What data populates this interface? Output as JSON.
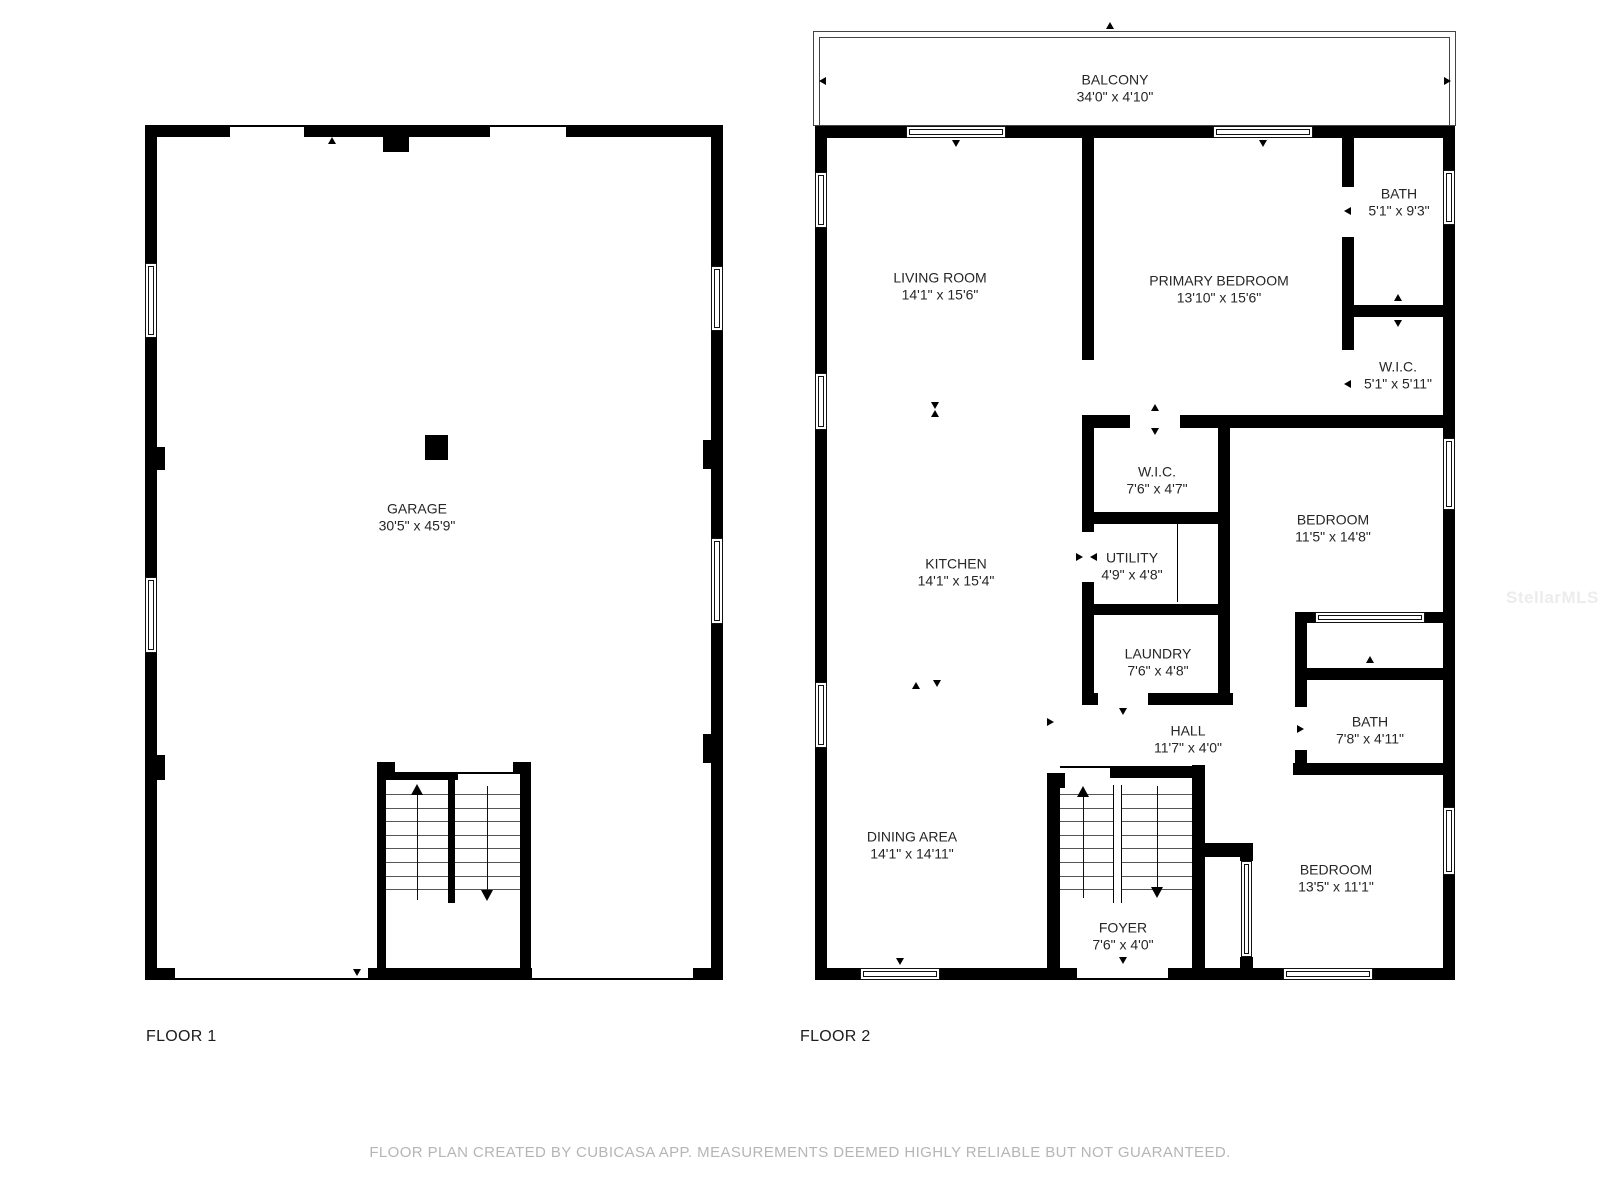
{
  "page": {
    "background": "#ffffff",
    "wall_color": "#000000",
    "label_color": "#262626",
    "tread_color": "#555555",
    "disclaimer_color": "#b5b5b5",
    "watermark_color": "#ececec"
  },
  "watermark": {
    "text": "StellarMLS",
    "x": 1506,
    "y": 588
  },
  "disclaimer": {
    "text": "FLOOR PLAN CREATED BY CUBICASA APP. MEASUREMENTS DEEMED HIGHLY RELIABLE BUT NOT GUARANTEED.",
    "y": 1144
  },
  "floors": [
    {
      "id": "floor1",
      "title": "FLOOR 1",
      "title_x": 146,
      "title_y": 1028,
      "boxes": [],
      "windows": [
        [
          145,
          263,
          12,
          75
        ],
        [
          145,
          577,
          12,
          76
        ],
        [
          711,
          266,
          12,
          65
        ],
        [
          711,
          538,
          12,
          86
        ]
      ],
      "walls": [
        [
          145,
          125,
          85,
          12
        ],
        [
          304,
          125,
          186,
          12
        ],
        [
          566,
          125,
          157,
          12
        ],
        [
          383,
          137,
          26,
          15
        ],
        [
          145,
          125,
          12,
          138
        ],
        [
          145,
          338,
          12,
          239
        ],
        [
          145,
          653,
          12,
          327
        ],
        [
          711,
          125,
          12,
          141
        ],
        [
          711,
          331,
          12,
          207
        ],
        [
          711,
          624,
          12,
          356
        ],
        [
          157,
          447,
          8,
          23
        ],
        [
          157,
          755,
          8,
          25
        ],
        [
          703,
          440,
          8,
          29
        ],
        [
          703,
          734,
          8,
          29
        ],
        [
          145,
          968,
          30,
          12
        ],
        [
          368,
          968,
          164,
          12
        ],
        [
          693,
          968,
          30,
          12
        ],
        [
          377,
          762,
          18,
          11
        ],
        [
          377,
          773,
          9,
          207
        ],
        [
          386,
          772,
          72,
          8
        ],
        [
          513,
          762,
          18,
          11
        ],
        [
          520,
          773,
          11,
          207
        ],
        [
          448,
          780,
          7,
          123
        ],
        [
          425,
          435,
          23,
          25
        ]
      ],
      "lines": [
        [
          230,
          125,
          74,
          2
        ],
        [
          490,
          125,
          76,
          2
        ],
        [
          175,
          978,
          193,
          2
        ],
        [
          532,
          978,
          161,
          2
        ],
        [
          458,
          772,
          62,
          2
        ]
      ],
      "treads": [
        [
          386,
          794,
          62,
          1
        ],
        [
          386,
          808,
          62,
          1
        ],
        [
          386,
          821,
          62,
          1
        ],
        [
          386,
          835,
          62,
          1
        ],
        [
          386,
          848,
          62,
          1
        ],
        [
          386,
          862,
          62,
          1
        ],
        [
          386,
          876,
          62,
          1
        ],
        [
          386,
          889,
          62,
          1
        ],
        [
          455,
          794,
          65,
          1
        ],
        [
          455,
          808,
          65,
          1
        ],
        [
          455,
          821,
          65,
          1
        ],
        [
          455,
          835,
          65,
          1
        ],
        [
          455,
          848,
          65,
          1
        ],
        [
          455,
          862,
          65,
          1
        ],
        [
          455,
          876,
          65,
          1
        ],
        [
          455,
          889,
          65,
          1
        ]
      ],
      "labels": [
        {
          "name": "GARAGE",
          "dims": "30'5\" x 45'9\"",
          "x": 417,
          "y": 517
        }
      ],
      "arrows": [
        {
          "x": 417,
          "y1": 784,
          "y2": 900,
          "dir": "up"
        },
        {
          "x": 487,
          "y1": 786,
          "y2": 901,
          "dir": "down"
        }
      ],
      "markers": [
        {
          "x": 332,
          "y": 141,
          "dir": "up"
        },
        {
          "x": 357,
          "y": 973,
          "dir": "down"
        }
      ]
    },
    {
      "id": "floor2",
      "title": "FLOOR 2",
      "title_x": 800,
      "title_y": 1028,
      "boxes": [
        [
          813,
          31,
          643,
          95
        ],
        [
          819,
          37,
          631,
          89
        ]
      ],
      "windows": [
        [
          815,
          172,
          12,
          56
        ],
        [
          815,
          373,
          12,
          57
        ],
        [
          815,
          682,
          12,
          66
        ],
        [
          1443,
          170,
          12,
          55
        ],
        [
          1443,
          438,
          12,
          72
        ],
        [
          1443,
          807,
          12,
          68
        ],
        [
          906,
          126,
          100,
          12
        ],
        [
          1213,
          126,
          100,
          12
        ],
        [
          1315,
          612,
          110,
          11
        ],
        [
          860,
          968,
          80,
          12
        ],
        [
          1283,
          968,
          90,
          12
        ],
        [
          1241,
          861,
          11,
          96
        ]
      ],
      "walls": [
        [
          815,
          126,
          91,
          12
        ],
        [
          1006,
          126,
          207,
          12
        ],
        [
          1313,
          126,
          142,
          12
        ],
        [
          815,
          126,
          12,
          46
        ],
        [
          815,
          228,
          12,
          145
        ],
        [
          815,
          430,
          12,
          252
        ],
        [
          815,
          748,
          12,
          232
        ],
        [
          1443,
          126,
          12,
          44
        ],
        [
          1443,
          225,
          12,
          213
        ],
        [
          1443,
          510,
          12,
          297
        ],
        [
          1443,
          875,
          12,
          105
        ],
        [
          815,
          968,
          45,
          12
        ],
        [
          940,
          968,
          137,
          12
        ],
        [
          1168,
          968,
          115,
          12
        ],
        [
          1373,
          968,
          82,
          12
        ],
        [
          1082,
          137,
          12,
          223
        ],
        [
          1082,
          415,
          12,
          117
        ],
        [
          1082,
          582,
          12,
          123
        ],
        [
          1342,
          137,
          12,
          50
        ],
        [
          1342,
          237,
          12,
          113
        ],
        [
          1354,
          305,
          89,
          12
        ],
        [
          1082,
          415,
          48,
          13
        ],
        [
          1180,
          415,
          263,
          13
        ],
        [
          1218,
          428,
          12,
          277
        ],
        [
          1082,
          512,
          148,
          12
        ],
        [
          1082,
          604,
          148,
          11
        ],
        [
          1082,
          693,
          16,
          12
        ],
        [
          1148,
          693,
          85,
          12
        ],
        [
          1295,
          612,
          12,
          93
        ],
        [
          1295,
          612,
          20,
          11
        ],
        [
          1425,
          612,
          18,
          11
        ],
        [
          1295,
          668,
          148,
          12
        ],
        [
          1295,
          680,
          12,
          27
        ],
        [
          1295,
          750,
          12,
          13
        ],
        [
          1293,
          763,
          150,
          12
        ],
        [
          1192,
          765,
          13,
          13
        ],
        [
          1192,
          766,
          13,
          77
        ],
        [
          1192,
          843,
          61,
          14
        ],
        [
          1192,
          857,
          13,
          123
        ],
        [
          1240,
          843,
          13,
          18
        ],
        [
          1240,
          957,
          13,
          23
        ],
        [
          1047,
          773,
          18,
          15
        ],
        [
          1047,
          788,
          13,
          192
        ],
        [
          1110,
          766,
          82,
          12
        ]
      ],
      "lines": [
        [
          1060,
          766,
          50,
          2
        ],
        [
          1077,
          978,
          91,
          2
        ],
        [
          1177,
          517,
          1,
          85
        ],
        [
          1113,
          785,
          1,
          118
        ],
        [
          1121,
          785,
          1,
          118
        ]
      ],
      "treads": [
        [
          1060,
          794,
          53,
          1
        ],
        [
          1060,
          808,
          53,
          1
        ],
        [
          1060,
          821,
          53,
          1
        ],
        [
          1060,
          835,
          53,
          1
        ],
        [
          1060,
          848,
          53,
          1
        ],
        [
          1060,
          862,
          53,
          1
        ],
        [
          1060,
          876,
          53,
          1
        ],
        [
          1060,
          889,
          53,
          1
        ],
        [
          1122,
          794,
          70,
          1
        ],
        [
          1122,
          808,
          70,
          1
        ],
        [
          1122,
          821,
          70,
          1
        ],
        [
          1122,
          835,
          70,
          1
        ],
        [
          1122,
          848,
          70,
          1
        ],
        [
          1122,
          862,
          70,
          1
        ],
        [
          1122,
          876,
          70,
          1
        ],
        [
          1122,
          889,
          70,
          1
        ]
      ],
      "labels": [
        {
          "name": "BALCONY",
          "dims": "34'0\" x 4'10\"",
          "x": 1115,
          "y": 88
        },
        {
          "name": "LIVING ROOM",
          "dims": "14'1\" x 15'6\"",
          "x": 940,
          "y": 286
        },
        {
          "name": "PRIMARY BEDROOM",
          "dims": "13'10\" x 15'6\"",
          "x": 1219,
          "y": 289
        },
        {
          "name": "BATH",
          "dims": "5'1\" x 9'3\"",
          "x": 1399,
          "y": 202
        },
        {
          "name": "W.I.C.",
          "dims": "5'1\" x 5'11\"",
          "x": 1398,
          "y": 375
        },
        {
          "name": "W.I.C.",
          "dims": "7'6\" x 4'7\"",
          "x": 1157,
          "y": 480
        },
        {
          "name": "UTILITY",
          "dims": "4'9\" x 4'8\"",
          "x": 1132,
          "y": 566
        },
        {
          "name": "BEDROOM",
          "dims": "11'5\" x 14'8\"",
          "x": 1333,
          "y": 528
        },
        {
          "name": "KITCHEN",
          "dims": "14'1\" x 15'4\"",
          "x": 956,
          "y": 572
        },
        {
          "name": "LAUNDRY",
          "dims": "7'6\" x 4'8\"",
          "x": 1158,
          "y": 662
        },
        {
          "name": "HALL",
          "dims": "11'7\" x 4'0\"",
          "x": 1188,
          "y": 739
        },
        {
          "name": "BATH",
          "dims": "7'8\" x 4'11\"",
          "x": 1370,
          "y": 730
        },
        {
          "name": "DINING AREA",
          "dims": "14'1\" x 14'11\"",
          "x": 912,
          "y": 845
        },
        {
          "name": "FOYER",
          "dims": "7'6\" x 4'0\"",
          "x": 1123,
          "y": 936
        },
        {
          "name": "BEDROOM",
          "dims": "13'5\" x 11'1\"",
          "x": 1336,
          "y": 878
        }
      ],
      "arrows": [
        {
          "x": 1083,
          "y1": 786,
          "y2": 898,
          "dir": "up"
        },
        {
          "x": 1157,
          "y1": 786,
          "y2": 898,
          "dir": "down"
        }
      ],
      "markers": [
        {
          "x": 1110,
          "y": 26,
          "dir": "up"
        },
        {
          "x": 823,
          "y": 81,
          "dir": "left"
        },
        {
          "x": 1448,
          "y": 81,
          "dir": "right"
        },
        {
          "x": 956,
          "y": 144,
          "dir": "down"
        },
        {
          "x": 1263,
          "y": 144,
          "dir": "down"
        },
        {
          "x": 1348,
          "y": 211,
          "dir": "left"
        },
        {
          "x": 1398,
          "y": 298,
          "dir": "up"
        },
        {
          "x": 1398,
          "y": 324,
          "dir": "down"
        },
        {
          "x": 1348,
          "y": 384,
          "dir": "left"
        },
        {
          "x": 1155,
          "y": 408,
          "dir": "up"
        },
        {
          "x": 1155,
          "y": 432,
          "dir": "down"
        },
        {
          "x": 935,
          "y": 406,
          "dir": "down"
        },
        {
          "x": 935,
          "y": 414,
          "dir": "up"
        },
        {
          "x": 1080,
          "y": 557,
          "dir": "right"
        },
        {
          "x": 1094,
          "y": 557,
          "dir": "left"
        },
        {
          "x": 916,
          "y": 686,
          "dir": "up"
        },
        {
          "x": 937,
          "y": 684,
          "dir": "down"
        },
        {
          "x": 1370,
          "y": 660,
          "dir": "up"
        },
        {
          "x": 1123,
          "y": 712,
          "dir": "down"
        },
        {
          "x": 1301,
          "y": 729,
          "dir": "right"
        },
        {
          "x": 1051,
          "y": 722,
          "dir": "right"
        },
        {
          "x": 900,
          "y": 962,
          "dir": "down"
        },
        {
          "x": 1123,
          "y": 961,
          "dir": "down"
        }
      ]
    }
  ]
}
